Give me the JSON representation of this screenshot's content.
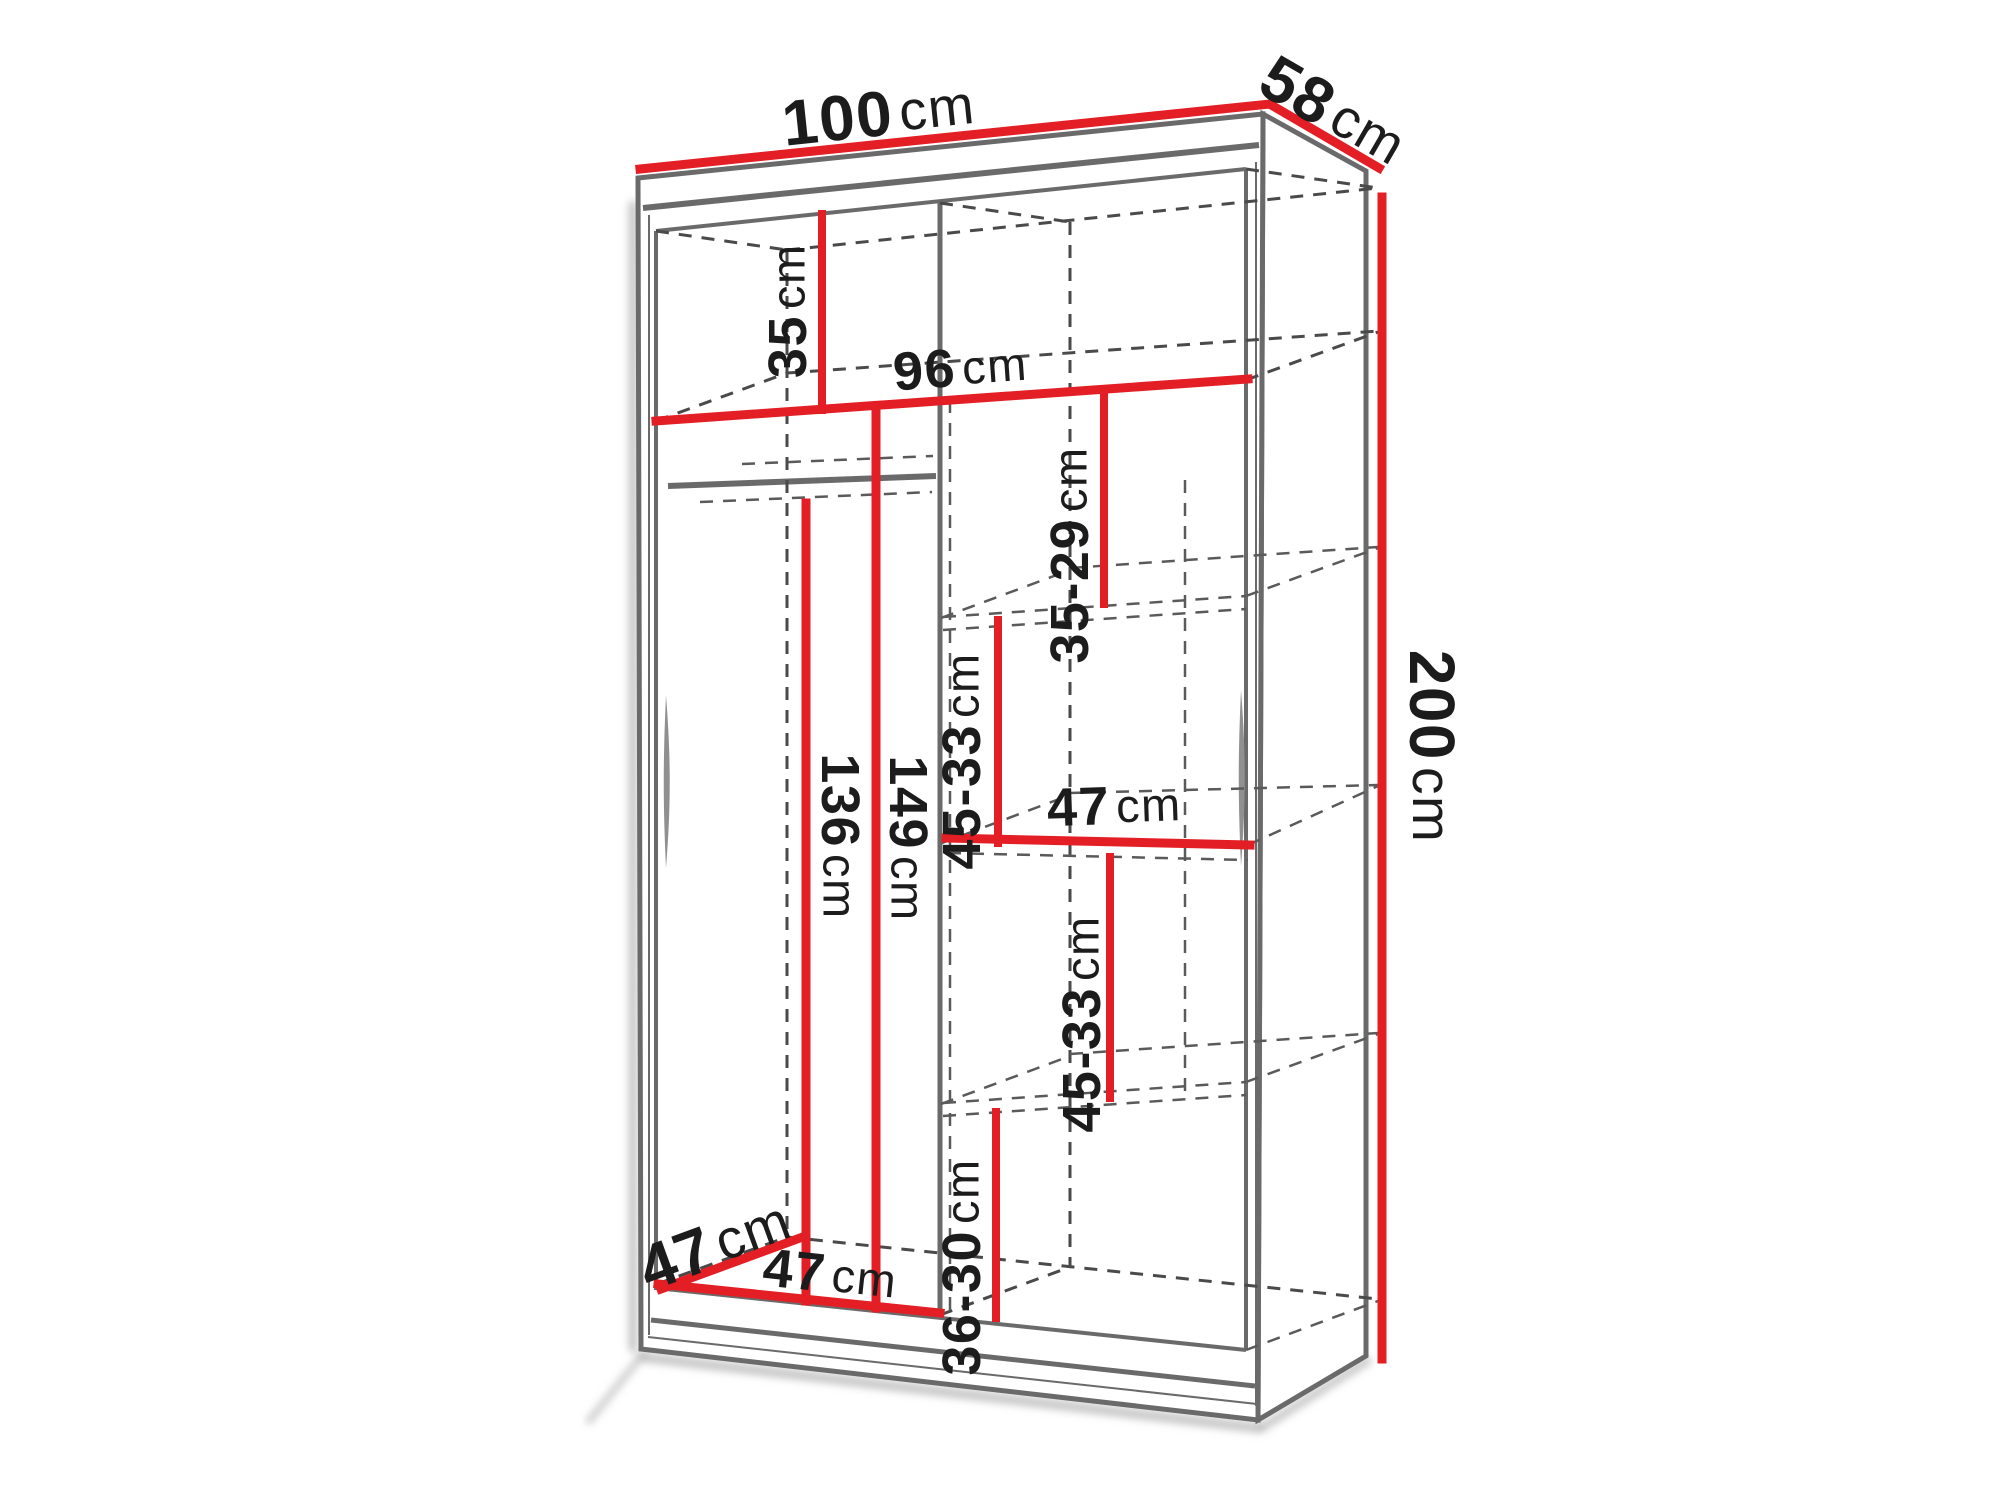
{
  "diagram": {
    "title": "wardrobe-dimension-diagram",
    "unit": "cm",
    "colors": {
      "dimension_line": "#e31e24",
      "structure_line": "#6a6a6a",
      "hidden_line": "#4a4a4a",
      "label_text": "#1c1c1c",
      "background": "#ffffff"
    },
    "dimensions": {
      "overall_width": {
        "value": "100",
        "unit": "cm"
      },
      "overall_depth": {
        "value": "58",
        "unit": "cm"
      },
      "overall_height": {
        "value": "200",
        "unit": "cm"
      },
      "top_shelf_height": {
        "value": "35",
        "unit": "cm"
      },
      "interior_width": {
        "value": "96",
        "unit": "cm"
      },
      "right_top_gap": {
        "value": "35-29",
        "unit": "cm"
      },
      "right_upper_gap": {
        "value": "45-33",
        "unit": "cm"
      },
      "right_shelf_width": {
        "value": "47",
        "unit": "cm"
      },
      "left_rail_height": {
        "value": "136",
        "unit": "cm"
      },
      "left_interior_height": {
        "value": "149",
        "unit": "cm"
      },
      "right_lower_gap": {
        "value": "45-33",
        "unit": "cm"
      },
      "right_bottom_gap": {
        "value": "36-30",
        "unit": "cm"
      },
      "interior_depth": {
        "value": "47",
        "unit": "cm"
      },
      "left_section_width": {
        "value": "47",
        "unit": "cm"
      }
    }
  }
}
